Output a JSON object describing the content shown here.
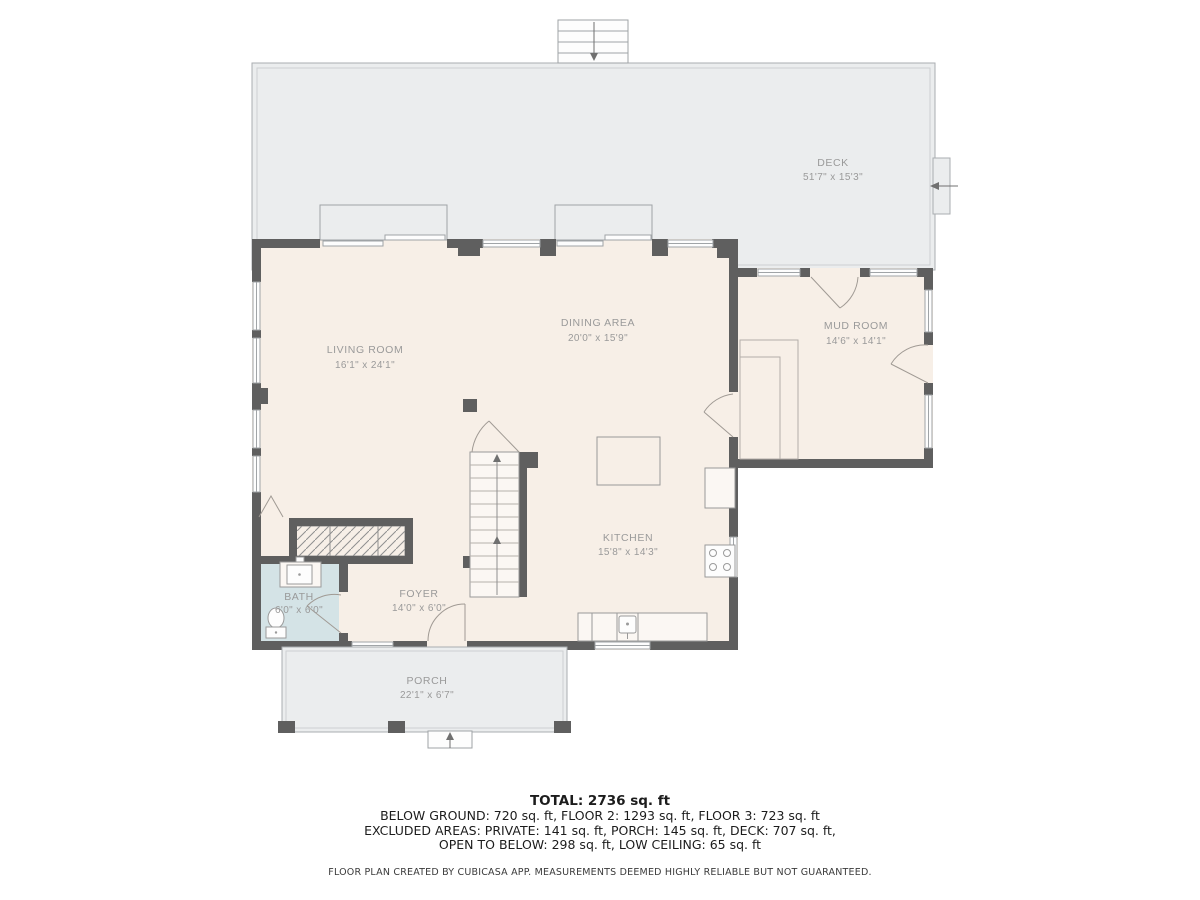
{
  "colors": {
    "floor_fill": "#f7efe7",
    "deck_fill": "#ebedee",
    "bath_fill": "#d4e3e6",
    "wall": "#5f5f5f",
    "label_text": "#9a9a9a"
  },
  "rooms": [
    {
      "name": "DECK",
      "dims": "51'7\" x 15'3\""
    },
    {
      "name": "LIVING ROOM",
      "dims": "16'1\" x 24'1\""
    },
    {
      "name": "DINING AREA",
      "dims": "20'0\" x 15'9\""
    },
    {
      "name": "MUD ROOM",
      "dims": "14'6\" x 14'1\""
    },
    {
      "name": "KITCHEN",
      "dims": "15'8\" x 14'3\""
    },
    {
      "name": "BATH",
      "dims": "6'0\" x 6'0\""
    },
    {
      "name": "FOYER",
      "dims": "14'0\" x 6'0\""
    },
    {
      "name": "PORCH",
      "dims": "22'1\" x 6'7\""
    }
  ],
  "summary": {
    "total": "TOTAL: 2736 sq. ft",
    "line1": "BELOW GROUND: 720 sq. ft, FLOOR 2: 1293 sq. ft, FLOOR 3: 723 sq. ft",
    "line2": "EXCLUDED AREAS: PRIVATE: 141 sq. ft, PORCH: 145 sq. ft, DECK: 707 sq. ft,",
    "line3": "OPEN TO BELOW: 298 sq. ft, LOW CEILING: 65 sq. ft"
  },
  "footer": "FLOOR PLAN CREATED BY CUBICASA APP. MEASUREMENTS DEEMED HIGHLY RELIABLE BUT NOT GUARANTEED."
}
